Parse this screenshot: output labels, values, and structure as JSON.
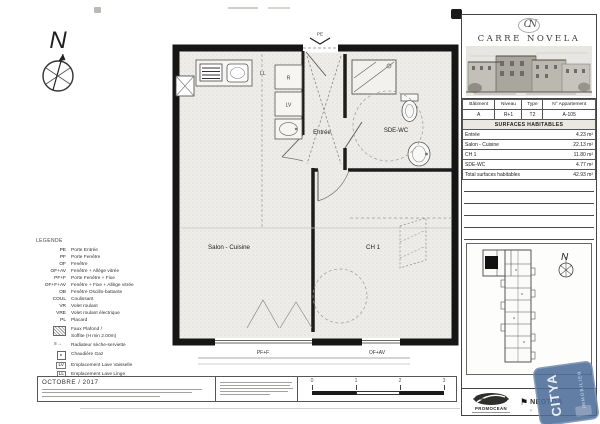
{
  "compass": {
    "north": "N"
  },
  "plan": {
    "entrance_label": "PE",
    "rooms": {
      "entree": "Entrée",
      "sde_wc": "SDE-WC",
      "salon": "Salon - Cuisine",
      "ch1": "CH 1"
    },
    "window_labels": {
      "salon": "PF+F",
      "ch1": "OF+AV"
    },
    "appliances": {
      "ll": "LL",
      "lv": "LV",
      "r": "R"
    }
  },
  "legend": {
    "title": "LEGENDE",
    "items": [
      {
        "abbr": "PE",
        "label": "Porte Entrée"
      },
      {
        "abbr": "PF",
        "label": "Porte Fenêtre"
      },
      {
        "abbr": "OF",
        "label": "Fenêtre"
      },
      {
        "abbr": "OF+AV",
        "label": "Fenêtre + Allège vitrée"
      },
      {
        "abbr": "PF+F",
        "label": "Porte Fenêtre + Fixe"
      },
      {
        "abbr": "OF+F+AV",
        "label": "Fenêtre + Fixe + Allège vitrée"
      },
      {
        "abbr": "OB",
        "label": "Fenêtre Oscillo-battante"
      },
      {
        "abbr": "COUL",
        "label": "Coulissant"
      },
      {
        "abbr": "VR",
        "label": "Volet roulant"
      },
      {
        "abbr": "VRE",
        "label": "Volet roulant électrique"
      },
      {
        "abbr": "PL",
        "label": "Placard"
      },
      {
        "abbr": "",
        "icon": "hatch",
        "label": "Faux Plafond /\nSoffite (H min 2.00m)"
      },
      {
        "abbr": "",
        "icon": "radiator",
        "label": "Radiateur sèche-serviette"
      },
      {
        "abbr": "",
        "icon": "boiler",
        "label": "Chaudière Gaz"
      },
      {
        "abbr": "LV",
        "label": "Emplacement Lave Vaisselle"
      },
      {
        "abbr": "LL",
        "label": "Emplacement Lave Linge"
      },
      {
        "abbr": "R",
        "label": "Emplacement Réfrigérateur"
      },
      {
        "abbr": "C",
        "label": "Emplacement Plaque de cuisson"
      }
    ]
  },
  "panel": {
    "brand": {
      "monogram": "CN",
      "name": "CARRE NOVELA"
    },
    "table": {
      "headers": [
        "Bâtiment",
        "Niveau",
        "Type",
        "N° Appartement"
      ],
      "unit": {
        "batiment": "A",
        "niveau": "R+1",
        "type": "T2",
        "appartement": "A-105"
      },
      "section": "SURFACES HABITABLES",
      "rows": [
        {
          "label": "Entrée",
          "value": "4.23 m²"
        },
        {
          "label": "Salon - Cuisine",
          "value": "22.13 m²"
        },
        {
          "label": "CH 1",
          "value": "11.80 m²"
        },
        {
          "label": "SDE-WC",
          "value": "4.77 m²"
        }
      ],
      "total": {
        "label": "Total surfaces habitables",
        "value": "42.93 m²"
      }
    },
    "keyplan": {
      "north": "N"
    }
  },
  "footer": {
    "date": "OCTOBRE / 2017",
    "scale": {
      "ticks": [
        "0",
        "1",
        "2",
        "3"
      ]
    },
    "logos": {
      "promocean": "PROMOCEAN",
      "neotoa": "NEOTOA",
      "neotoa_sub": "P",
      "stamp_line1": "CITYA",
      "stamp_line2": "IMMOBILIER"
    }
  },
  "colors": {
    "stamp_blue": "#4d6c98",
    "wall": "#161616"
  }
}
